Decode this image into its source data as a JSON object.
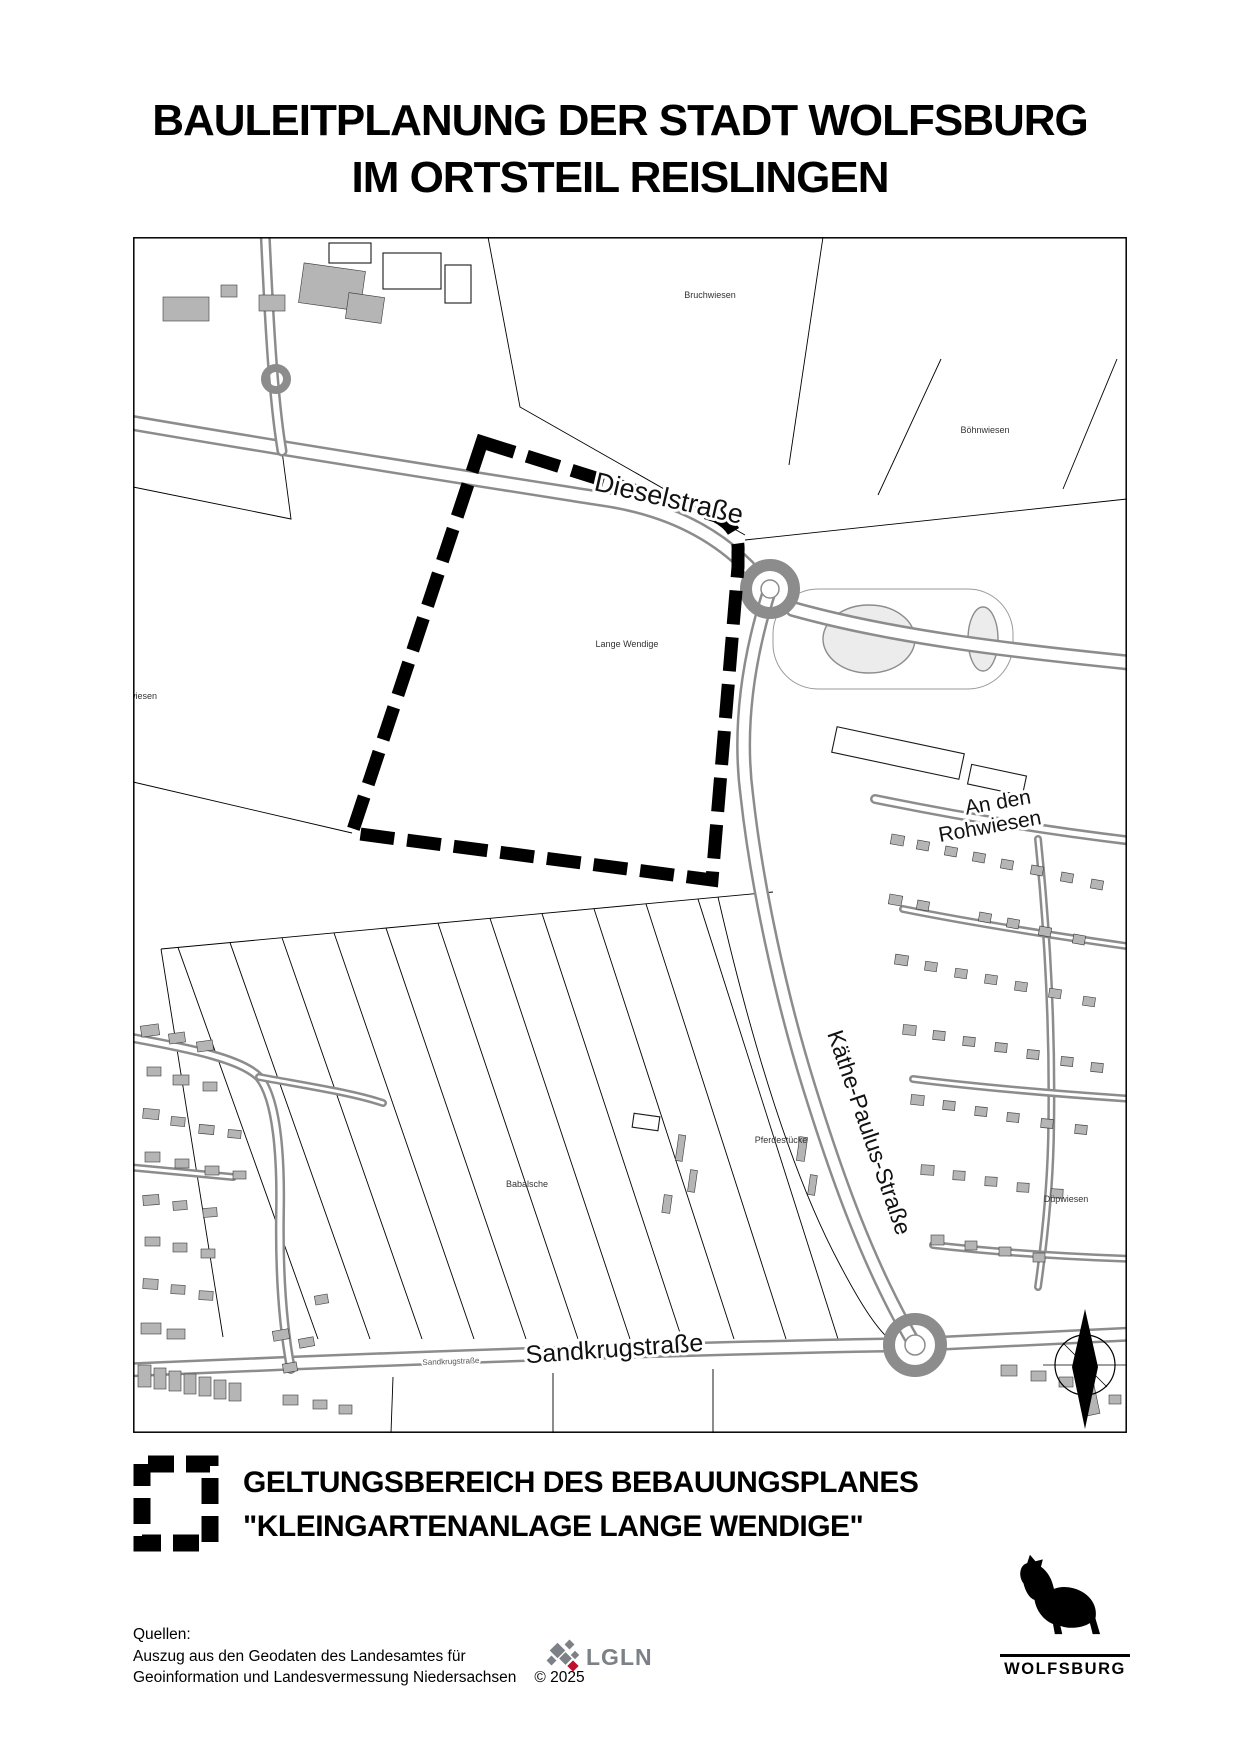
{
  "page": {
    "title_line1": "BAULEITPLANUNG DER STADT WOLFSBURG",
    "title_line2": "IM ORTSTEIL REISLINGEN"
  },
  "map": {
    "street_labels": {
      "dieselstrasse": "Dieselstraße",
      "kaethe_paulus_strasse": "Käthe-Paulus-Straße",
      "sandkrugstrasse": "Sandkrugstraße",
      "sandkrugstrasse_small": "Sandkrugstraße",
      "an_den_rohwiesen_line1": "An den",
      "an_den_rohwiesen_line2": "Rohwiesen"
    },
    "field_labels": {
      "bruchwiesen": "Bruchwiesen",
      "boehnwiesen": "Böhnwiesen",
      "lange_wendige": "Lange Wendige",
      "wiesen_partial": "wiesen",
      "babalsche": "Babalsche",
      "pferdestuecke": "Pferdestücke",
      "duepwiesen": "Düpwiesen"
    }
  },
  "legend": {
    "line1": "GELTUNGSBEREICH DES BEBAUUNGSPLANES",
    "line2": "\"KLEINGARTENANLAGE LANGE WENDIGE\""
  },
  "sources": {
    "heading": "Quellen:",
    "line1": "Auszug aus den Geodaten des Landesamtes für",
    "line2": "Geoinformation und Landesvermessung Niedersachsen",
    "copyright": "© 2025",
    "lgln_label": "LGLN"
  },
  "footer": {
    "wolfsburg_label": "WOLFSBURG"
  },
  "colors": {
    "plan_boundary": "#000000",
    "road_gray": "#8c8c8c",
    "building_gray": "#b5b5b5",
    "lgln_gray": "#7b8187",
    "lgln_red": "#c00f2d"
  }
}
